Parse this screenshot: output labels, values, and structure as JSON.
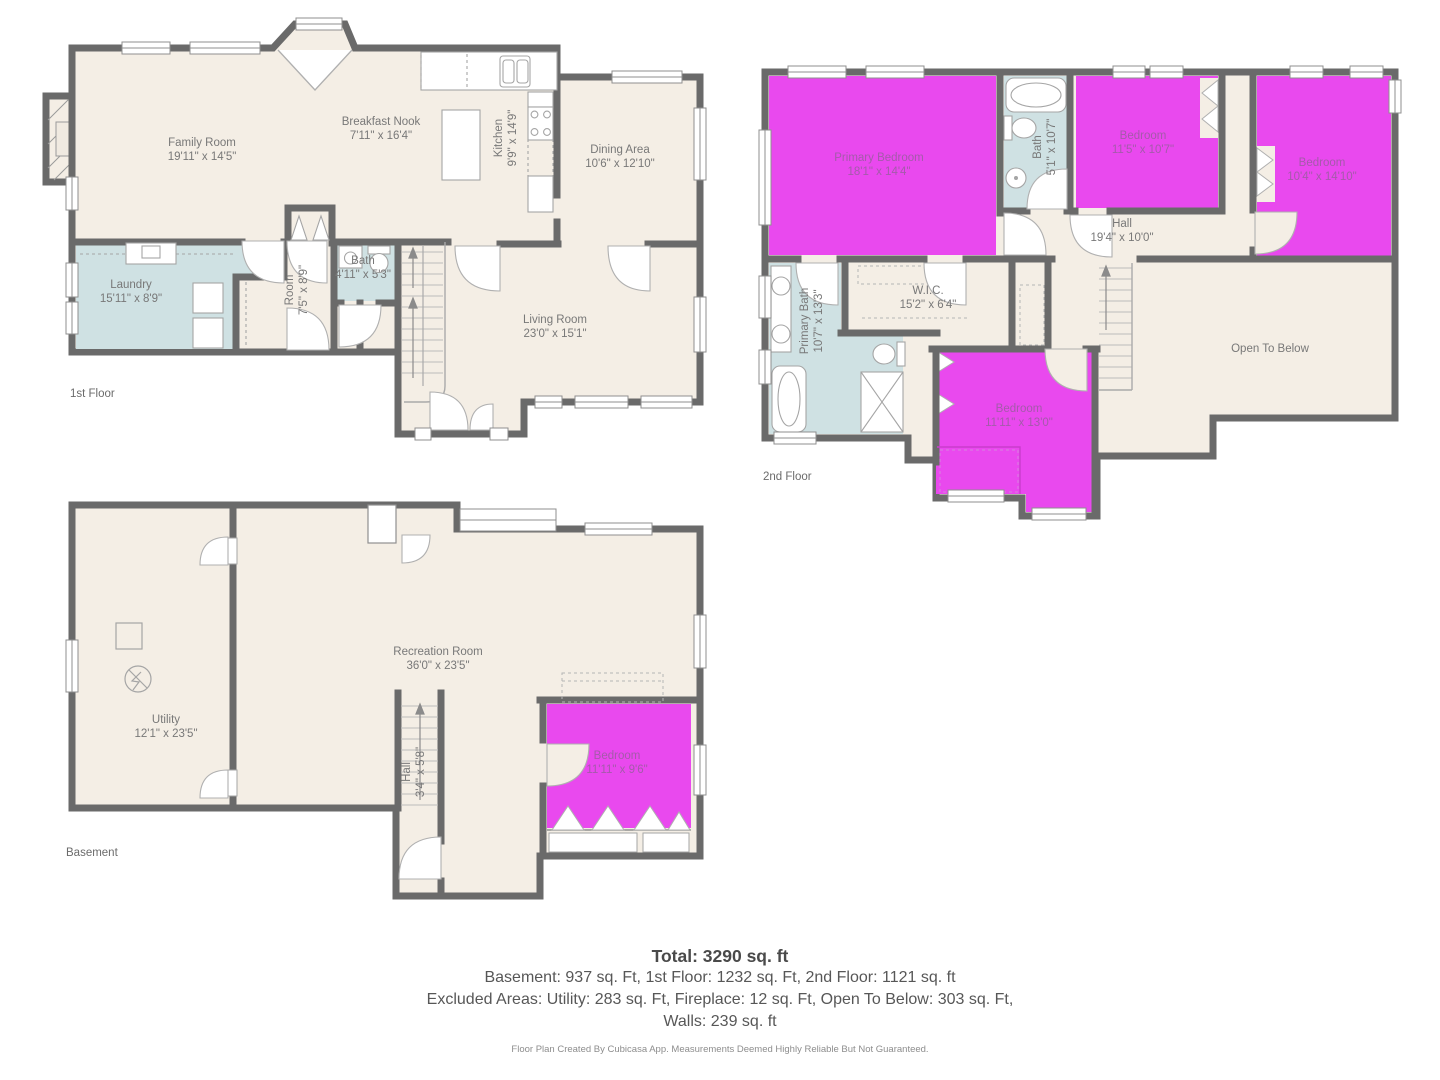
{
  "document": {
    "type": "floor-plan",
    "creator_note_visible": true
  },
  "colors": {
    "background": "#ffffff",
    "floor_fill": "#f4eee5",
    "wet_room_fill": "#cfe1e3",
    "highlight_room_fill": "#e949ee",
    "wall": "#6a6a6a",
    "fixture_stroke": "#a5a5a5",
    "room_label": "#787878",
    "highlight_room_label": "#a45aaa",
    "summary_text": "#575757",
    "footer_text": "#8d8d8d"
  },
  "floors": [
    {
      "label": "1st Floor",
      "rooms": [
        {
          "name": "Family Room",
          "dims": "19'11\" x 14'5\""
        },
        {
          "name": "Breakfast Nook",
          "dims": "7'11\" x 16'4\""
        },
        {
          "name": "Kitchen",
          "dims": "9'9\" x 14'9\""
        },
        {
          "name": "Dining Area",
          "dims": "10'6\" x 12'10\""
        },
        {
          "name": "Laundry",
          "dims": "15'11\" x 8'9\""
        },
        {
          "name": "Room",
          "dims": "7'5\" x 8'9\""
        },
        {
          "name": "Bath",
          "dims": "4'11\" x 5'3\""
        },
        {
          "name": "Living Room",
          "dims": "23'0\" x 15'1\""
        }
      ]
    },
    {
      "label": "2nd Floor",
      "rooms": [
        {
          "name": "Primary Bedroom",
          "dims": "18'1\" x 14'4\""
        },
        {
          "name": "Bath",
          "dims": "5'1\" x 10'7\""
        },
        {
          "name": "Bedroom",
          "dims": "11'5\" x 10'7\""
        },
        {
          "name": "Bedroom",
          "dims": "10'4\" x 14'10\""
        },
        {
          "name": "Hall",
          "dims": "19'4\" x 10'0\""
        },
        {
          "name": "W.I.C.",
          "dims": "15'2\" x 6'4\""
        },
        {
          "name": "Primary Bath",
          "dims": "10'7\" x 13'3\""
        },
        {
          "name": "Bedroom",
          "dims": "11'11\" x 13'0\""
        },
        {
          "name": "Open To Below",
          "dims": ""
        }
      ]
    },
    {
      "label": "Basement",
      "rooms": [
        {
          "name": "Recreation Room",
          "dims": "36'0\" x 23'5\""
        },
        {
          "name": "Utility",
          "dims": "12'1\" x 23'5\""
        },
        {
          "name": "Hall",
          "dims": "3'4\" x 5'8\""
        },
        {
          "name": "Bedroom",
          "dims": "11'11\" x 9'6\""
        }
      ]
    }
  ],
  "summary": {
    "total": "Total: 3290 sq. ft",
    "by_floor": "Basement: 937 sq. Ft, 1st Floor: 1232 sq. Ft, 2nd Floor: 1121 sq. ft",
    "excluded": "Excluded Areas: Utility: 283 sq. Ft, Fireplace: 12 sq. Ft, Open To Below: 303 sq. Ft,",
    "walls": "Walls: 239 sq. ft",
    "footer": "Floor Plan Created By Cubicasa App. Measurements Deemed Highly Reliable But Not Guaranteed."
  }
}
